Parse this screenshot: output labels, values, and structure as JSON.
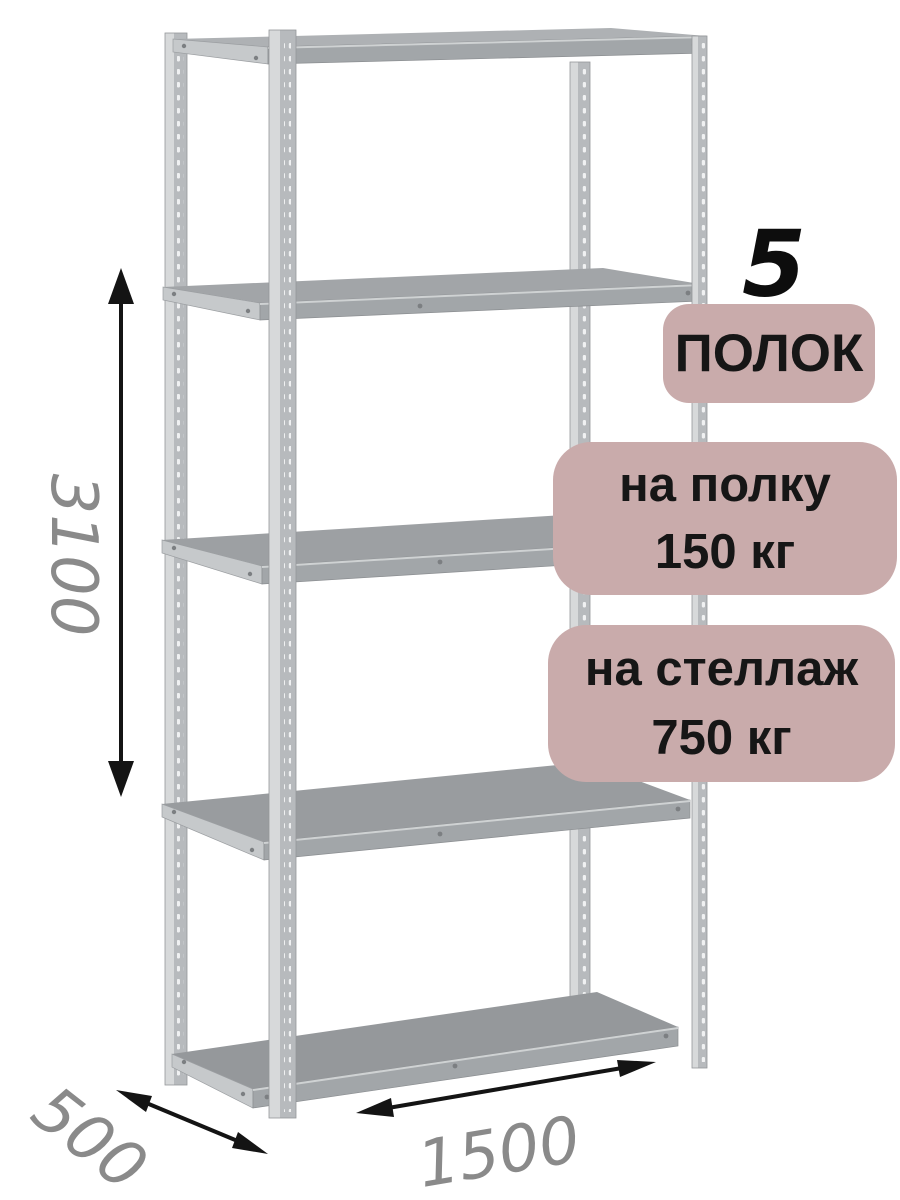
{
  "annotations": {
    "shelf_count": {
      "number": "5",
      "label": "ПОЛОК"
    },
    "shelf_load": {
      "line1": "на полку",
      "line2": "150 кг"
    },
    "rack_load": {
      "line1": "на стеллаж",
      "line2": "750 кг"
    }
  },
  "dimensions": {
    "height": "3100",
    "depth": "500",
    "width": "1500"
  },
  "colors": {
    "background": "#ffffff",
    "badge_bg": "#c9abab",
    "badge_text": "#161616",
    "big_number": "#0d0d0d",
    "dimension_text": "#8a8a8a",
    "arrow": "#141414",
    "metal_light": "#d7d9da",
    "metal_mid": "#b7babd",
    "metal_surface_top": "#aeb1b4",
    "metal_surface_bottom": "#95989b",
    "metal_side": "#c6c9cb",
    "metal_hole": "#f0f1f2",
    "rivet": "#7c7f82"
  }
}
